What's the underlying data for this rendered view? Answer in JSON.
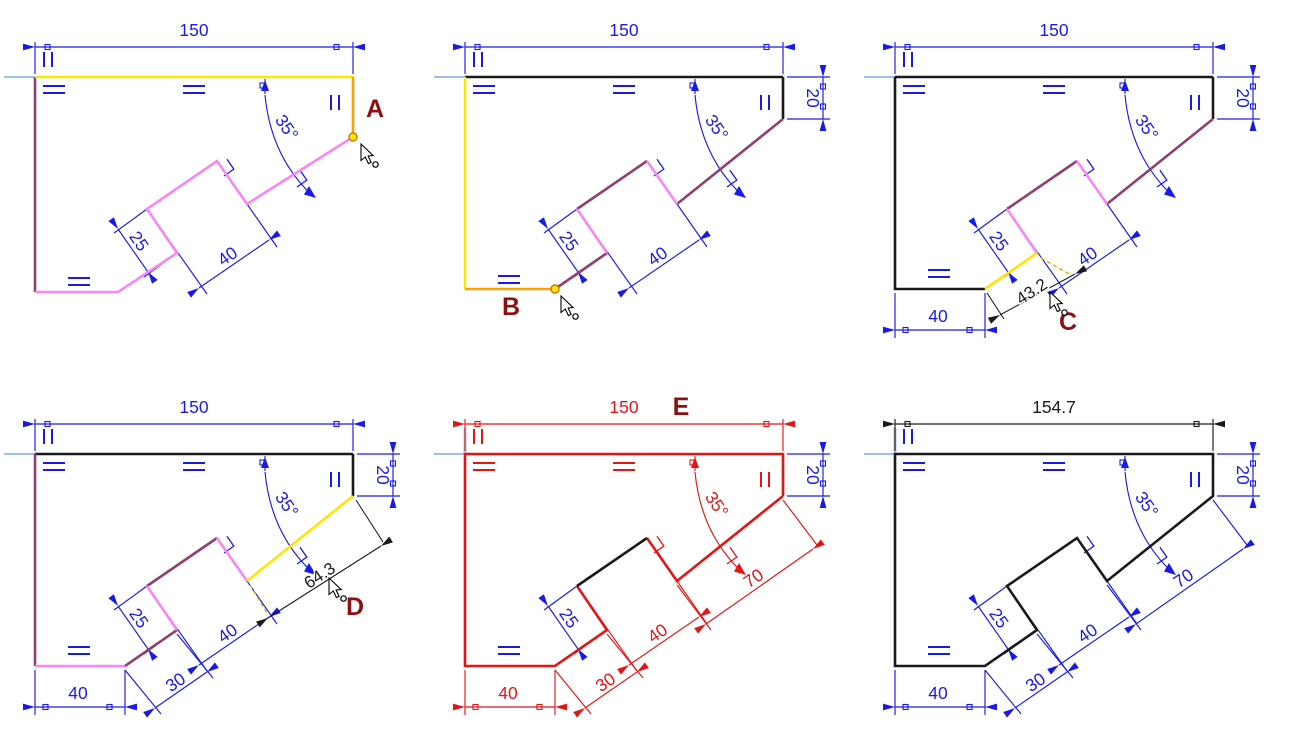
{
  "title": "Sketch dimensioning tutorial steps",
  "colors": {
    "dimension_blue": "#1A1AE6",
    "highlight_red": "#E31515",
    "line_black": "#1A1A1A",
    "selected_yellow": "#FFE500",
    "selected_orange": "#FFA000",
    "underdefined_pink": "#FA86F3",
    "underdefined_purple": "#8E4070",
    "dashed_yellow": "#D9B800",
    "step_label_dark_red": "#8B1111",
    "axis_blue": "#7FA8E8",
    "origin_light_blue": "#A9C9F5"
  },
  "panels": {
    "a": {
      "label": "A",
      "dims": {
        "top": "150",
        "angle": "35°",
        "notch_offset": "25",
        "notch_top": "40"
      }
    },
    "b": {
      "label": "B",
      "dims": {
        "top": "150",
        "right": "20",
        "angle": "35°",
        "notch_offset": "25",
        "notch_top": "40"
      }
    },
    "c": {
      "label": "C",
      "dims": {
        "top": "150",
        "right": "20",
        "angle": "35°",
        "notch_offset": "25",
        "notch_top": "40",
        "bottom": "40",
        "pending": "43.2"
      }
    },
    "d": {
      "label": "D",
      "dims": {
        "top": "150",
        "right": "20",
        "angle": "35°",
        "notch_offset": "25",
        "notch_top": "40",
        "bottom": "40",
        "lower_diag": "30",
        "pending": "64.3"
      }
    },
    "e": {
      "label": "E",
      "dims": {
        "top": "150",
        "right": "20",
        "angle": "35°",
        "notch_offset": "25",
        "notch_top": "40",
        "bottom": "40",
        "lower_diag": "30",
        "upper_diag": "70"
      }
    },
    "f": {
      "dims": {
        "top": "154.7",
        "right": "20",
        "angle": "35°",
        "notch_offset": "25",
        "notch_top": "40",
        "bottom": "40",
        "lower_diag": "30",
        "upper_diag": "70"
      }
    }
  }
}
